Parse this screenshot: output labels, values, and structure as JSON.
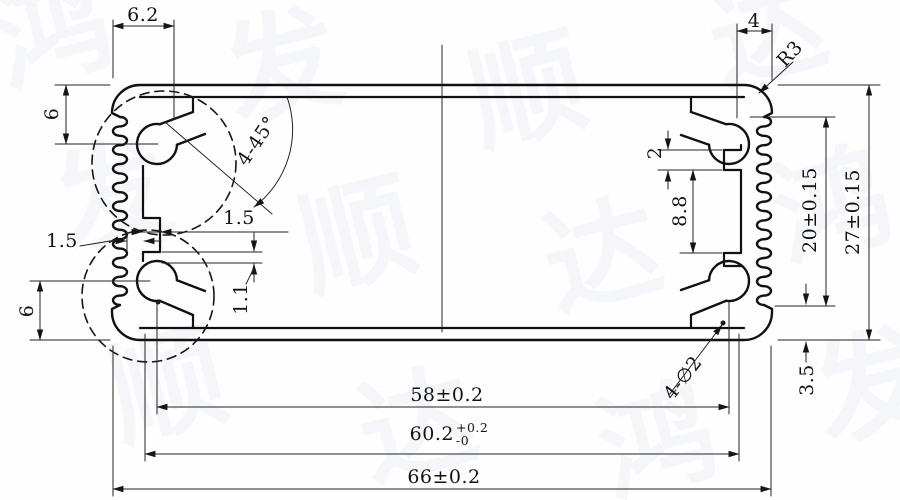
{
  "watermark": {
    "text": "鸿发顺达",
    "tiles": [
      "鸿",
      "发",
      "顺",
      "达",
      "发",
      "顺",
      "达",
      "鸿",
      "顺",
      "达",
      "鸿",
      "发"
    ]
  },
  "drawing": {
    "type": "extrusion-profile-cross-section",
    "line_color": "#151515",
    "paper_color": "#fefefe"
  },
  "dimensions": {
    "boss_offset_top_left": "6.2",
    "boss_offset_top_right": "4",
    "corner_radius": "R3",
    "boss_depth_top": "6",
    "chamfer_note": "4-45°",
    "wall_thickness": "1.5",
    "rib_thickness": "1.5",
    "rib_gap": "1.1",
    "boss_depth_bottom": "6",
    "groove_width": "2",
    "groove_spacing": "8.8",
    "fin_zone_height": "20±0.15",
    "overall_height": "27±0.15",
    "edge_margin": "3.5",
    "screw_hole_note": "4-∅2",
    "hole_pitch": "58±0.2",
    "slot_width_value": "60.2",
    "slot_width_tol_plus": "+0.2",
    "slot_width_tol_minus": "-0",
    "overall_width": "66±0.2"
  }
}
